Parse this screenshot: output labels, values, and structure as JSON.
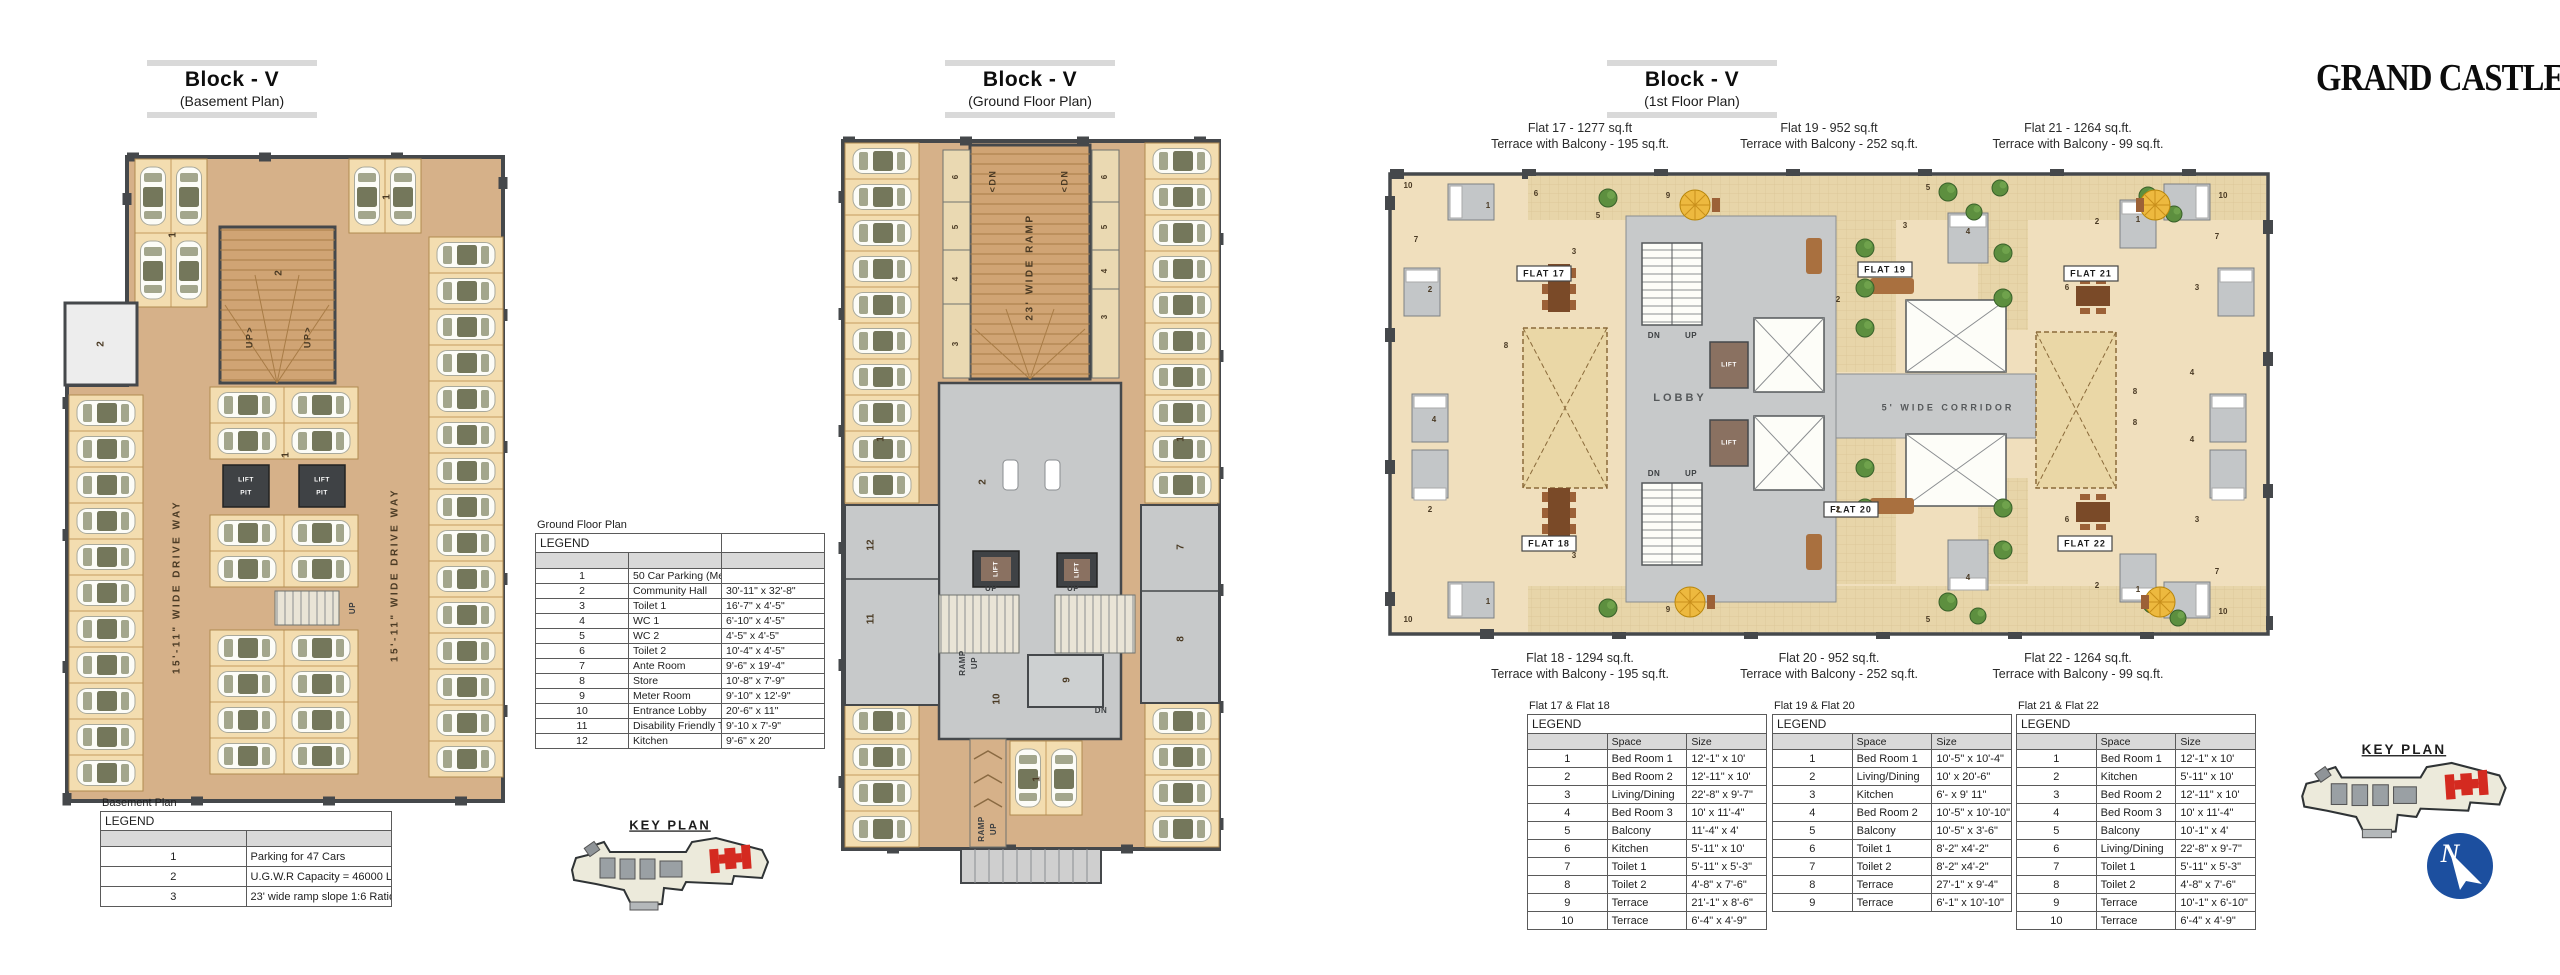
{
  "brand": "GRAND CASTLE",
  "colors": {
    "floor_tan": "#d6b189",
    "stall_tan": "#f3ddb0",
    "wall_dark": "#45484b",
    "ramp_tan": "#d0a474",
    "gray_floor": "#c7c9ca",
    "flat_beige": "#f0dfbd",
    "terrace_beige": "#e7d5a9",
    "tree_green": "#5d8f3f",
    "umbrella_yellow": "#edb93f",
    "furniture_brown": "#9c6137",
    "block_red": "#d42a20",
    "compass_blue": "#1c4f9f",
    "legend_header_gray": "#d9d9d9",
    "bar_gray": "#d9d9d9"
  },
  "sections": {
    "basement": {
      "title": "Block - V",
      "subtitle": "(Basement Plan)"
    },
    "ground": {
      "title": "Block - V",
      "subtitle": "(Ground Floor Plan)"
    },
    "first": {
      "title": "Block - V",
      "subtitle": "(1st Floor Plan)"
    }
  },
  "basement_legend": {
    "caption": "Basement Plan",
    "header": "LEGEND",
    "rows": [
      {
        "no": "1",
        "desc": "Parking for 47 Cars"
      },
      {
        "no": "2",
        "desc": "U.G.W.R Capacity = 46000 LTRS"
      },
      {
        "no": "3",
        "desc": "23' wide ramp slope 1:6 Ratio"
      }
    ]
  },
  "ground_legend": {
    "caption": "Ground Floor Plan",
    "header": "LEGEND",
    "rows": [
      {
        "no": "1",
        "desc": "50 Car Parking (Mechanical)",
        "size": ""
      },
      {
        "no": "2",
        "desc": "Community Hall",
        "size": "30'-11\" x 32'-8\""
      },
      {
        "no": "3",
        "desc": "Toilet 1",
        "size": "16'-7\" x 4'-5\""
      },
      {
        "no": "4",
        "desc": "WC 1",
        "size": "6'-10\" x 4'-5\""
      },
      {
        "no": "5",
        "desc": "WC 2",
        "size": "4'-5\" x 4'-5\""
      },
      {
        "no": "6",
        "desc": "Toilet 2",
        "size": "10'-4\" x 4'-5\""
      },
      {
        "no": "7",
        "desc": "Ante Room",
        "size": "9'-6\" x 19'-4\""
      },
      {
        "no": "8",
        "desc": "Store",
        "size": "10'-8\" x 7'-9\""
      },
      {
        "no": "9",
        "desc": "Meter Room",
        "size": "9'-10\" x 12'-9\""
      },
      {
        "no": "10",
        "desc": "Entrance Lobby",
        "size": "20'-6\" x 11\""
      },
      {
        "no": "11",
        "desc": "Disability Friendly Toilet",
        "size": "9'-10 x 7'-9\""
      },
      {
        "no": "12",
        "desc": "Kitchen",
        "size": "9'-6\" x 20'"
      }
    ]
  },
  "flat_tables": [
    {
      "caption": "Flat 17 & Flat 18",
      "header": "LEGEND",
      "col_space": "Space",
      "col_size": "Size",
      "rows": [
        {
          "no": "1",
          "space": "Bed Room 1",
          "size": "12'-1\" x 10'"
        },
        {
          "no": "2",
          "space": "Bed Room 2",
          "size": "12'-11\" x 10'"
        },
        {
          "no": "3",
          "space": "Living/Dining",
          "size": "22'-8\" x 9'-7\""
        },
        {
          "no": "4",
          "space": "Bed Room 3",
          "size": "10' x 11'-4\""
        },
        {
          "no": "5",
          "space": "Balcony",
          "size": "11'-4\" x 4'"
        },
        {
          "no": "6",
          "space": "Kitchen",
          "size": "5'-11\" x 10'"
        },
        {
          "no": "7",
          "space": "Toilet 1",
          "size": "5'-11\" x 5'-3\""
        },
        {
          "no": "8",
          "space": "Toilet 2",
          "size": "4'-8\" x 7'-6\""
        },
        {
          "no": "9",
          "space": "Terrace",
          "size": "21'-1\" x 8'-6\""
        },
        {
          "no": "10",
          "space": "Terrace",
          "size": "6'-4\" x 4'-9\""
        }
      ]
    },
    {
      "caption": "Flat 19 & Flat 20",
      "header": "LEGEND",
      "col_space": "Space",
      "col_size": "Size",
      "rows": [
        {
          "no": "1",
          "space": "Bed Room 1",
          "size": "10'-5\" x 10'-4\""
        },
        {
          "no": "2",
          "space": "Living/Dining",
          "size": "10' x 20'-6\""
        },
        {
          "no": "3",
          "space": "Kitchen",
          "size": "6'- x 9' 11\""
        },
        {
          "no": "4",
          "space": "Bed Room 2",
          "size": "10'-5\" x 10'-10\""
        },
        {
          "no": "5",
          "space": "Balcony",
          "size": "10'-5\" x 3'-6\""
        },
        {
          "no": "6",
          "space": "Toilet 1",
          "size": "8'-2\" x4'-2\""
        },
        {
          "no": "7",
          "space": "Toilet 2",
          "size": "8'-2\" x4'-2\""
        },
        {
          "no": "8",
          "space": "Terrace",
          "size": "27'-1\" x 9'-4\""
        },
        {
          "no": "9",
          "space": "Terrace",
          "size": "6'-1\" x 10'-10\""
        }
      ]
    },
    {
      "caption": "Flat 21 & Flat 22",
      "header": "LEGEND",
      "col_space": "Space",
      "col_size": "Size",
      "rows": [
        {
          "no": "1",
          "space": "Bed Room 1",
          "size": "12'-1\" x 10'"
        },
        {
          "no": "2",
          "space": "Kitchen",
          "size": "5'-11\" x 10'"
        },
        {
          "no": "3",
          "space": "Bed Room 2",
          "size": "12'-11\" x 10'"
        },
        {
          "no": "4",
          "space": "Bed Room 3",
          "size": "10' x 11'-4\""
        },
        {
          "no": "5",
          "space": "Balcony",
          "size": "10'-1\" x 4'"
        },
        {
          "no": "6",
          "space": "Living/Dining",
          "size": "22'-8\" x 9'-7\""
        },
        {
          "no": "7",
          "space": "Toilet 1",
          "size": "5'-11\" x 5'-3\""
        },
        {
          "no": "8",
          "space": "Toilet 2",
          "size": "4'-8\" x 7'-6\""
        },
        {
          "no": "9",
          "space": "Terrace",
          "size": "10'-1\" x 6'-10\""
        },
        {
          "no": "10",
          "space": "Terrace",
          "size": "6'-4\" x 4'-9\""
        }
      ]
    }
  ],
  "first_floor_annotations": {
    "top": [
      {
        "line1": "Flat 17 - 1277 sq.ft",
        "line2": "Terrace with Balcony - 195 sq.ft."
      },
      {
        "line1": "Flat 19 - 952 sq.ft",
        "line2": "Terrace with Balcony - 252 sq.ft."
      },
      {
        "line1": "Flat 21 - 1264 sq.ft.",
        "line2": "Terrace with Balcony - 99 sq.ft."
      }
    ],
    "bottom": [
      {
        "line1": "Flat 18 - 1294 sq.ft.",
        "line2": "Terrace with Balcony - 195 sq.ft."
      },
      {
        "line1": "Flat 20 - 952 sq.ft.",
        "line2": "Terrace with Balcony - 252 sq.ft."
      },
      {
        "line1": "Flat 22 - 1264 sq.ft.",
        "line2": "Terrace with Balcony - 99 sq.ft."
      }
    ]
  },
  "plan_labels": {
    "drive_way": "15'-11\" WIDE DRIVE WAY",
    "wide_ramp": "23' WIDE RAMP",
    "corridor": "5' WIDE CORRIDOR",
    "lobby": "LOBBY",
    "lift": "LIFT",
    "pit": "PIT",
    "up": "UP",
    "dn": "DN",
    "up_arrow": "UP>",
    "dn_arrow": "<DN",
    "ramp": "RAMP",
    "key_plan": "KEY PLAN",
    "north": "N",
    "flats": [
      "FLAT 17",
      "FLAT 18",
      "FLAT 19",
      "FLAT 20",
      "FLAT 21",
      "FLAT 22"
    ],
    "digits": [
      "1",
      "2",
      "3",
      "4",
      "5",
      "6",
      "7",
      "8",
      "9",
      "10",
      "11",
      "12"
    ]
  }
}
